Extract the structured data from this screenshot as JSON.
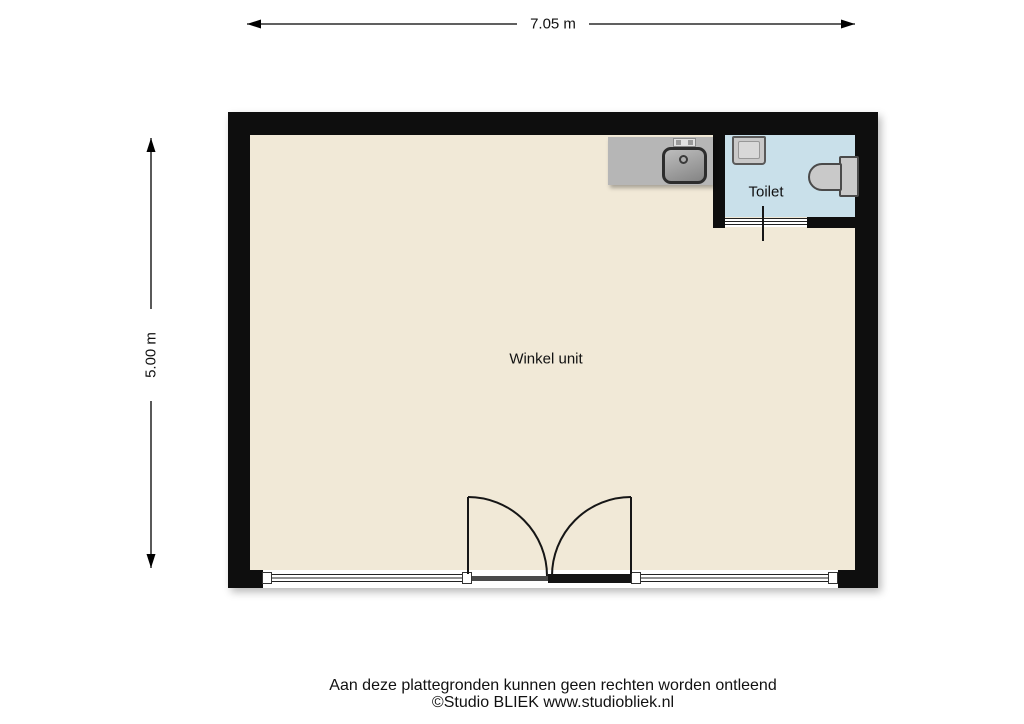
{
  "title": "Floor plan — Winkel unit",
  "dimensions": {
    "width_label": "7.05 m",
    "height_label": "5.00 m"
  },
  "rooms": {
    "main": {
      "label": "Winkel unit"
    },
    "toilet": {
      "label": "Toilet"
    }
  },
  "fixtures": {
    "counter": "kitchen-counter",
    "sink": "kitchen-sink",
    "faucet": "faucet",
    "basin": "hand-basin",
    "toilet_bowl": "toilet-bowl",
    "toilet_tank": "toilet-cistern"
  },
  "footer": {
    "disclaimer": "Aan deze plattegronden kunnen geen rechten worden ontleend",
    "credit": "©Studio BLIEK www.studiobliek.nl"
  },
  "colors": {
    "wall": "#0e0e0e",
    "floor_main": "#f1e9d7",
    "floor_toilet": "#c9e0ea",
    "fixture_gray": "#b6b6b6",
    "fixture_light": "#c9c9c9",
    "line": "#161616",
    "background": "#ffffff"
  }
}
